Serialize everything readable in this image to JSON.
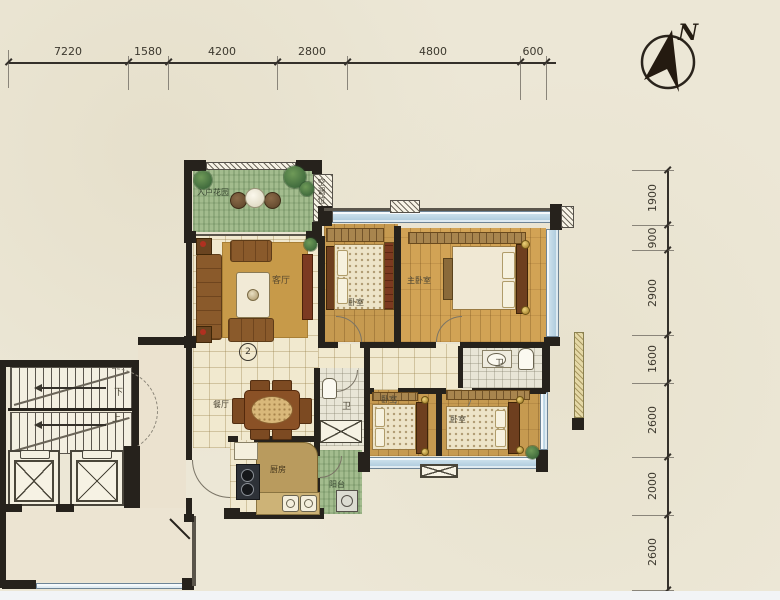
{
  "compass": {
    "north": "N"
  },
  "dimensions": {
    "top": [
      "7220",
      "1580",
      "4200",
      "2800",
      "4800",
      "600"
    ],
    "right": [
      "1900",
      "900",
      "2900",
      "1600",
      "2600",
      "2000",
      "2600"
    ]
  },
  "rooms": {
    "garden": "入户花园",
    "ac": "空调位",
    "living": "客厅",
    "dining": "餐厅",
    "kitchen": "厨房",
    "balcony": "阳台",
    "bath_main": "卫",
    "bath_small": "卫",
    "bedroom_top": "卧室",
    "bedroom_mid": "卧室",
    "bedroom_right": "卧室",
    "master": "主卧室"
  },
  "stairs": {
    "down": "下",
    "up": "上"
  },
  "markers": {
    "unit": "2"
  },
  "colors": {
    "paper": "#ece7d6",
    "wall": "#26221c",
    "window": "#b9d2e3",
    "wood": "#c69a50",
    "grass": "#a3bc8e",
    "rug": "#c79a49"
  }
}
